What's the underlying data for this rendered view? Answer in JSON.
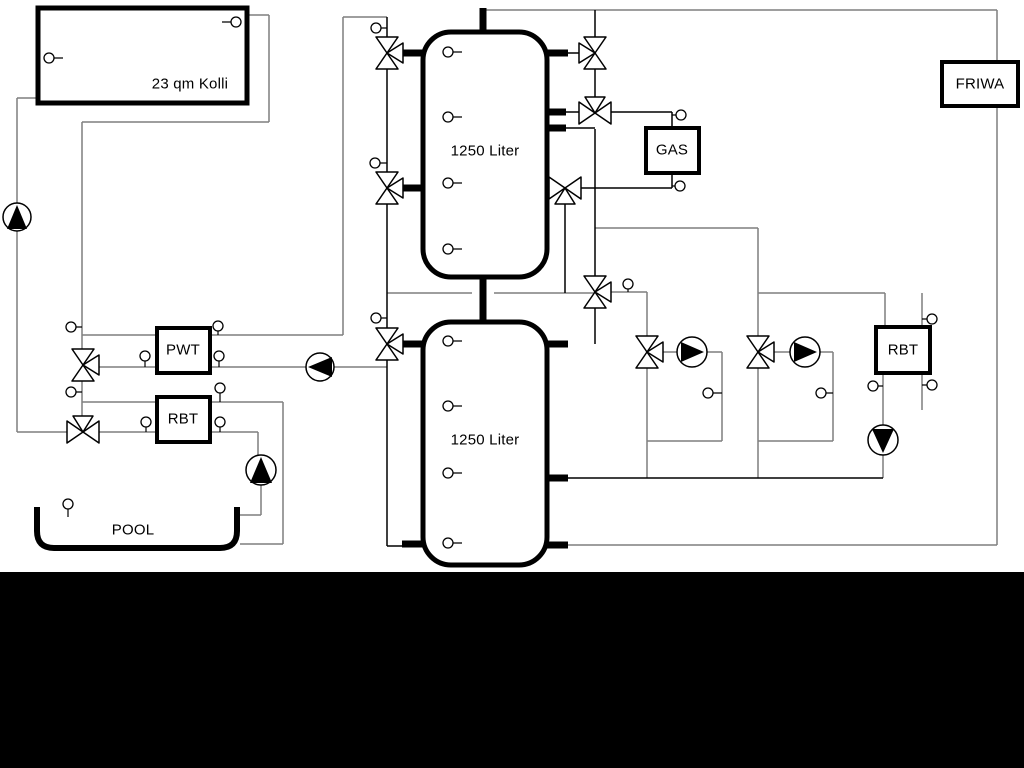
{
  "labels": {
    "collector": "23 qm Kolli",
    "buffer_tank_top": "1250 Liter",
    "buffer_tank_bottom": "1250 Liter",
    "gas_boiler": "GAS",
    "friwa": "FRIWA",
    "pool_heat_exchanger": "PWT",
    "rbt_left": "RBT",
    "rbt_right": "RBT",
    "pool": "POOL"
  },
  "colors": {
    "background": "#ffffff",
    "pipe_gray": "#7f7f7f",
    "pipe_black": "#000000",
    "footer_bar": "#000000",
    "box_border": "#000000"
  },
  "equipment": {
    "pumps": [
      {
        "name": "solar-pump",
        "direction": "up"
      },
      {
        "name": "pwt-pump",
        "direction": "left"
      },
      {
        "name": "pool-pump",
        "direction": "up"
      },
      {
        "name": "heating-pump-1",
        "direction": "right"
      },
      {
        "name": "heating-pump-2",
        "direction": "right"
      },
      {
        "name": "rbt-right-pump",
        "direction": "down"
      }
    ],
    "three_way_valve_count": 11,
    "temperature_sensor_count": 30
  }
}
